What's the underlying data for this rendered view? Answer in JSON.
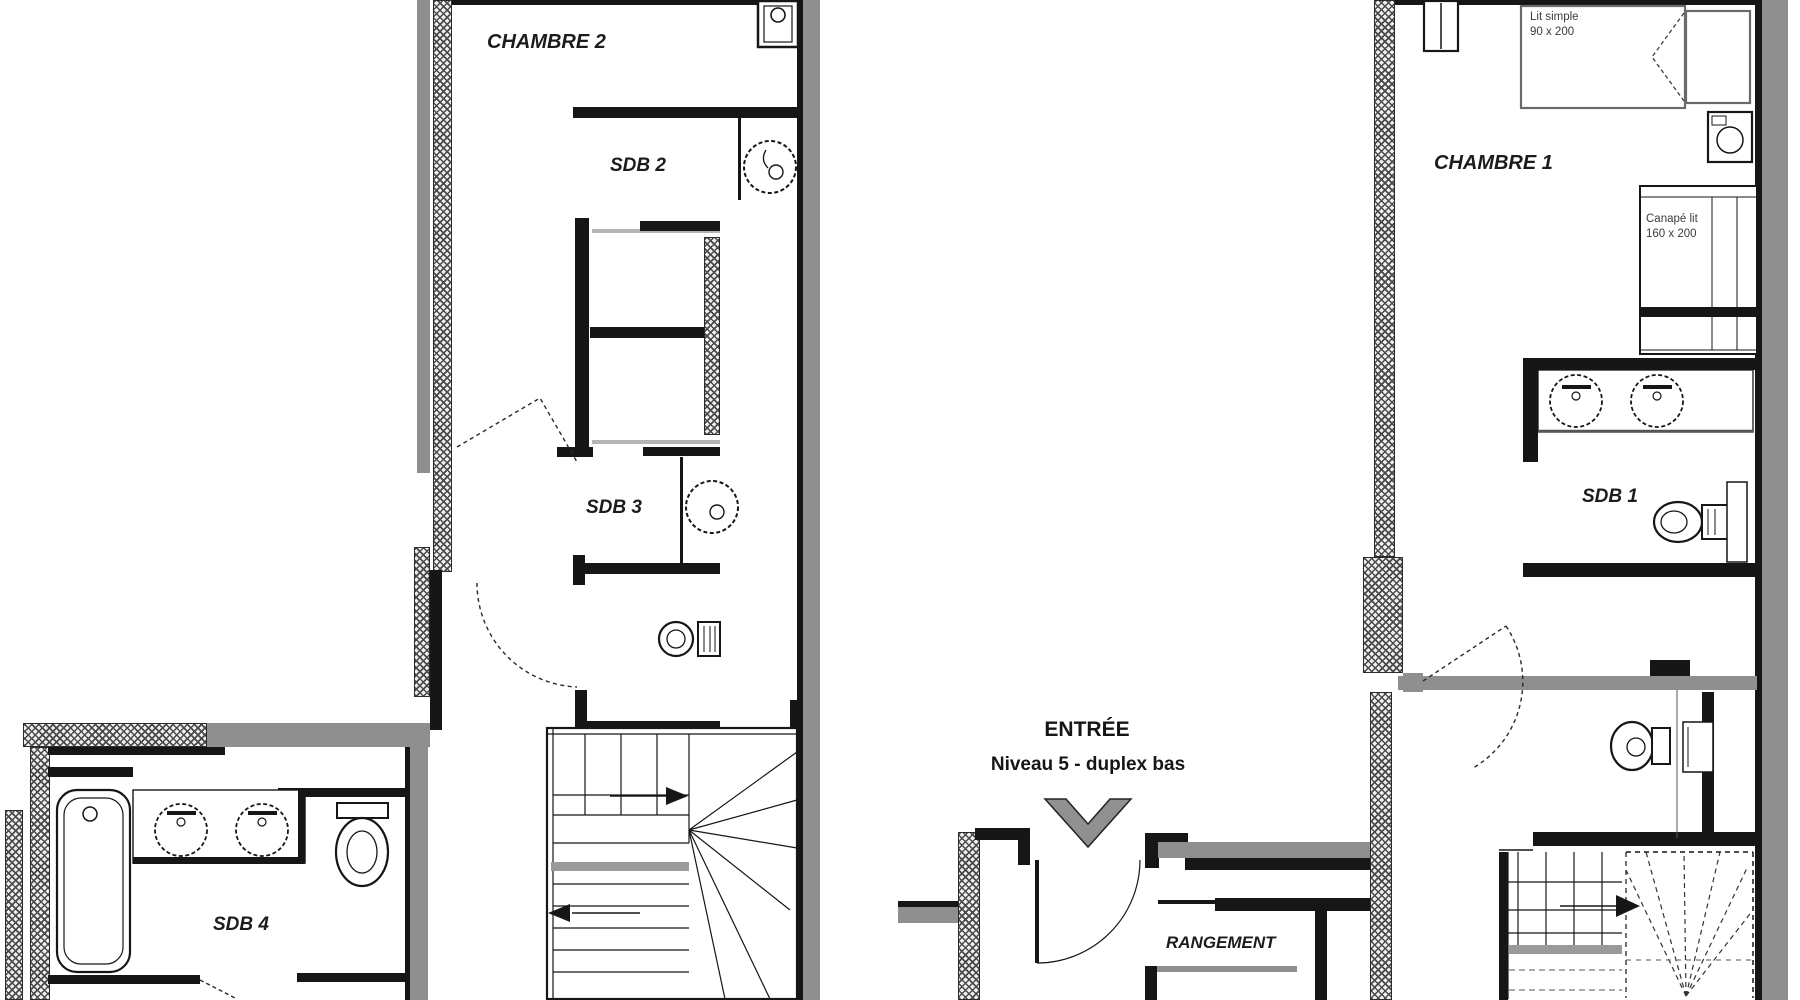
{
  "document_type": "architectural-floor-plan",
  "entrance": {
    "title": "ENTRÉE",
    "subtitle": "Niveau 5 - duplex bas"
  },
  "units": {
    "left": {
      "rooms": [
        {
          "name": "CHAMBRE 2"
        },
        {
          "name": "SDB 2"
        },
        {
          "name": "SDB 3"
        },
        {
          "name": "SDB 4"
        }
      ]
    },
    "right": {
      "rooms": [
        {
          "name": "CHAMBRE 1"
        },
        {
          "name": "SDB 1"
        },
        {
          "name": "RANGEMENT"
        }
      ],
      "furniture": [
        {
          "type": "single-bed",
          "label": [
            "Lit simple",
            "90 x 200"
          ]
        },
        {
          "type": "sofa-bed",
          "label": [
            "Canapé lit",
            "160 x 200"
          ]
        }
      ]
    }
  },
  "fixtures": [
    {
      "id": "washbasin-chambre2",
      "type": "washbasin"
    },
    {
      "id": "sink-sdb2",
      "type": "round-sink"
    },
    {
      "id": "sink-sdb3",
      "type": "round-sink"
    },
    {
      "id": "toilet-left-wc",
      "type": "toilet"
    },
    {
      "id": "staircase-left",
      "type": "winder-staircase"
    },
    {
      "id": "bathtub-sdb4",
      "type": "bathtub"
    },
    {
      "id": "vanity-sdb4",
      "type": "double-sink-vanity"
    },
    {
      "id": "toilet-sdb4",
      "type": "toilet"
    },
    {
      "id": "entry-door",
      "type": "door"
    },
    {
      "id": "entry-direction-arrow",
      "type": "arrow"
    },
    {
      "id": "wall-cabinet",
      "type": "cabinet"
    },
    {
      "id": "single-bed",
      "type": "bed"
    },
    {
      "id": "bedside-unit",
      "type": "bedside-table"
    },
    {
      "id": "sofa-bed",
      "type": "sofa-bed"
    },
    {
      "id": "vanity-sdb1",
      "type": "double-sink-vanity"
    },
    {
      "id": "toilet-sdb1",
      "type": "toilet"
    },
    {
      "id": "radiator-sdb1",
      "type": "radiator"
    },
    {
      "id": "toilet-right-wc",
      "type": "toilet"
    },
    {
      "id": "radiator-right-wc",
      "type": "radiator"
    },
    {
      "id": "staircase-right",
      "type": "staircase"
    }
  ],
  "colors": {
    "wall": "#161616",
    "masonry_gray": "#8f8f8f",
    "tread_gray": "#9a9a9a",
    "hatch_line": "#4a4a4a",
    "background": "#ffffff",
    "text": "#1c1c1c",
    "furniture_text": "#3d3d3d"
  }
}
